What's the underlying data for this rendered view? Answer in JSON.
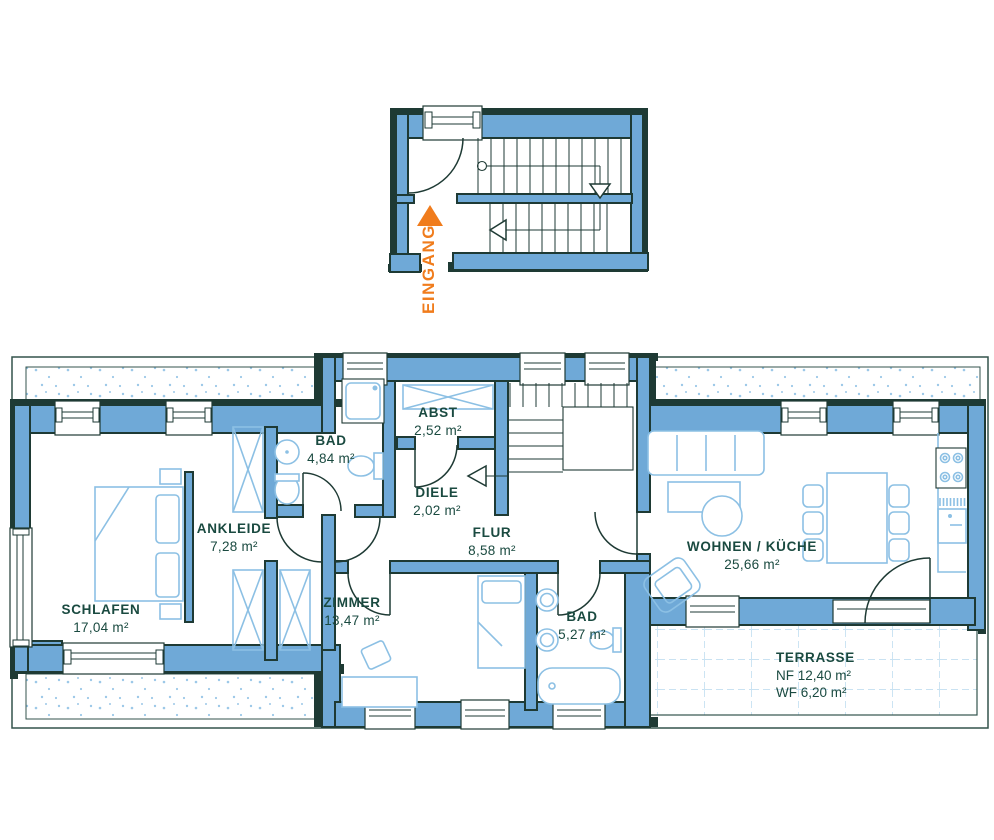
{
  "entrance": {
    "label": "EINGANG"
  },
  "rooms": {
    "schlafen": {
      "name": "SCHLAFEN",
      "area": "17,04 m²"
    },
    "ankleide": {
      "name": "ANKLEIDE",
      "area": "7,28 m²"
    },
    "bad_klein": {
      "name": "BAD",
      "area": "4,84 m²"
    },
    "abst": {
      "name": "ABST",
      "area": "2,52 m²"
    },
    "diele": {
      "name": "DIELE",
      "area": "2,02 m²"
    },
    "flur": {
      "name": "FLUR",
      "area": "8,58 m²"
    },
    "zimmer": {
      "name": "ZIMMER",
      "area": "13,47 m²"
    },
    "bad_gross": {
      "name": "BAD",
      "area": "5,27 m²"
    },
    "wohnen_kueche": {
      "name": "WOHNEN / KÜCHE",
      "area": "25,66 m²"
    }
  },
  "terrasse": {
    "name": "TERRASSE",
    "nf": "NF 12,40 m²",
    "wf": "WF 6,20 m²"
  },
  "colors": {
    "wall_fill": "#6FA9D7",
    "outline_dark": "#1E3A34",
    "furniture_line": "#8CC0E4",
    "label_text": "#1A4A40",
    "accent_orange": "#F07C1C",
    "stipple_dot": "#9CC8E8",
    "tile_line": "#B7D8EE",
    "border_line": "#33534C"
  }
}
